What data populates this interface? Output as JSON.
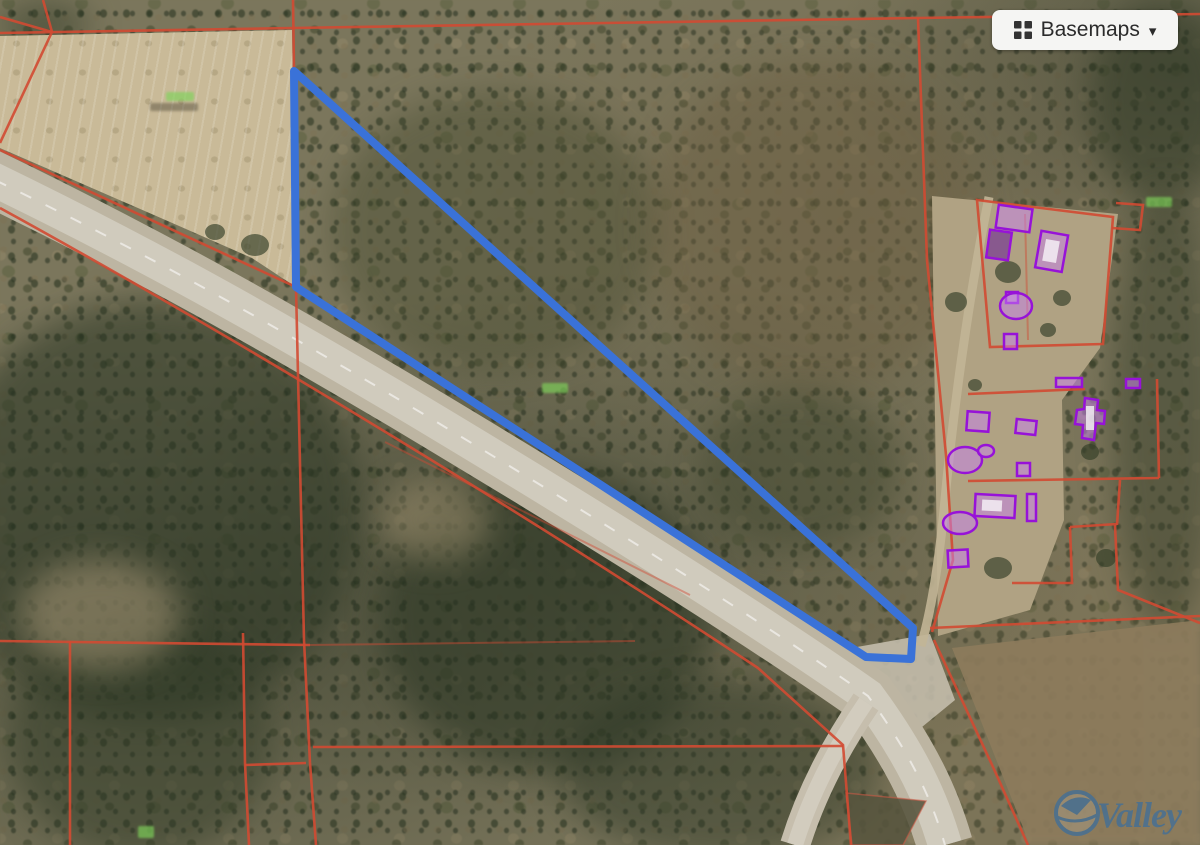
{
  "controls": {
    "basemaps_button": {
      "label": "Basemaps",
      "caret": "▾",
      "icon": "grid-icon"
    }
  },
  "watermark": {
    "brand": "Valley"
  },
  "map": {
    "overlay_markers": [
      {
        "kind": "acreage-label",
        "color": "#7fd45a"
      },
      {
        "kind": "acreage-label",
        "color": "#7fd45a"
      },
      {
        "kind": "acreage-label",
        "color": "#7fd45a"
      },
      {
        "kind": "acreage-label",
        "color": "#7fd45a"
      }
    ]
  },
  "colors": {
    "selected_parcel": "#3a72d8",
    "parcel_boundary": "#d14a32",
    "building_outline": "#9712d8",
    "building_fill": "rgba(200,130,240,0.5)",
    "basemaps_bg": "#f5f5f3",
    "basemaps_text": "#2b2b2b",
    "watermark_blue": "#2e6ca8",
    "acreage_label_green": "#7fd45a"
  }
}
